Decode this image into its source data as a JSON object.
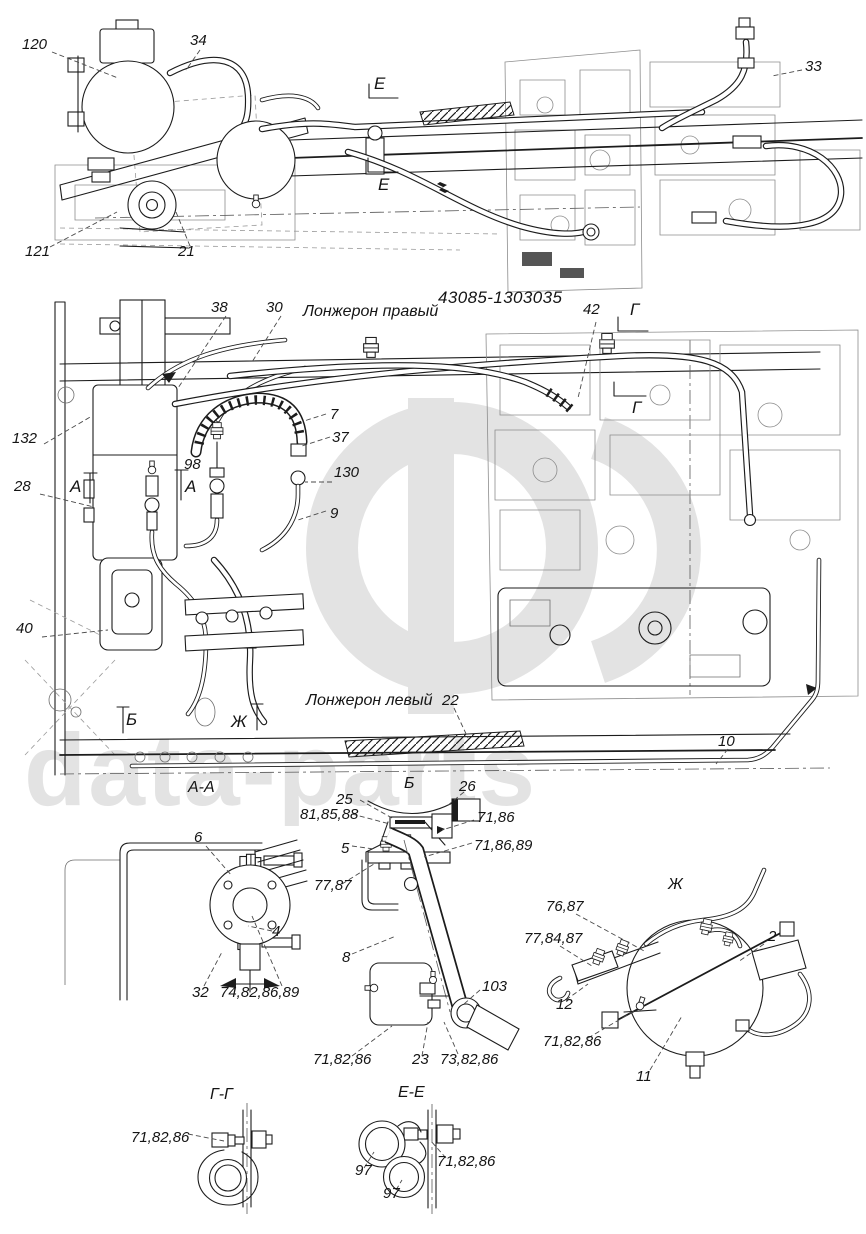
{
  "page": {
    "background": "#ffffff",
    "ink": "#1c1c1c",
    "watermark_color": "#e3e3e3",
    "watermark_text": "data-parts",
    "drawing_number": "43085-1303035"
  },
  "views": {
    "right_longeron_label": "Лонжерон правый",
    "left_longeron_label": "Лонжерон левый",
    "section_titles": [
      "А-А",
      "Б",
      "Ж",
      "Г-Г",
      "Е-Е"
    ],
    "section_markers": [
      "Е",
      "Е",
      "Г",
      "Г",
      "А",
      "А",
      "Б",
      "Ж"
    ]
  },
  "labels": [
    {
      "id": "120",
      "text": "120",
      "x": 22,
      "y": 36,
      "kind": "num"
    },
    {
      "id": "34",
      "text": "34",
      "x": 190,
      "y": 32,
      "kind": "num"
    },
    {
      "id": "33",
      "text": "33",
      "x": 805,
      "y": 58,
      "kind": "num"
    },
    {
      "id": "121",
      "text": "121",
      "x": 25,
      "y": 243,
      "kind": "num"
    },
    {
      "id": "21",
      "text": "21",
      "x": 178,
      "y": 243,
      "kind": "num"
    },
    {
      "id": "marker-e-top",
      "text": "Е",
      "x": 374,
      "y": 74,
      "kind": "marker"
    },
    {
      "id": "marker-e-bottom",
      "text": "Е",
      "x": 378,
      "y": 175,
      "kind": "marker"
    },
    {
      "id": "drawing-number",
      "text": "43085-1303035",
      "x": 438,
      "y": 288,
      "kind": "title-num"
    },
    {
      "id": "right-longeron",
      "text": "Лонжерон правый",
      "x": 303,
      "y": 303,
      "kind": "text"
    },
    {
      "id": "38",
      "text": "38",
      "x": 211,
      "y": 299,
      "kind": "num"
    },
    {
      "id": "30",
      "text": "30",
      "x": 266,
      "y": 299,
      "kind": "num"
    },
    {
      "id": "42",
      "text": "42",
      "x": 583,
      "y": 301,
      "kind": "num"
    },
    {
      "id": "marker-g-top",
      "text": "Г",
      "x": 630,
      "y": 300,
      "kind": "marker"
    },
    {
      "id": "marker-g-bottom",
      "text": "Г",
      "x": 632,
      "y": 398,
      "kind": "marker"
    },
    {
      "id": "132",
      "text": "132",
      "x": 12,
      "y": 430,
      "kind": "num"
    },
    {
      "id": "28",
      "text": "28",
      "x": 14,
      "y": 478,
      "kind": "num"
    },
    {
      "id": "98",
      "text": "98",
      "x": 184,
      "y": 456,
      "kind": "num"
    },
    {
      "id": "marker-a-left",
      "text": "А",
      "x": 70,
      "y": 477,
      "kind": "marker"
    },
    {
      "id": "marker-a-right",
      "text": "А",
      "x": 185,
      "y": 477,
      "kind": "marker"
    },
    {
      "id": "7",
      "text": "7",
      "x": 330,
      "y": 406,
      "kind": "num"
    },
    {
      "id": "37",
      "text": "37",
      "x": 332,
      "y": 429,
      "kind": "num"
    },
    {
      "id": "130",
      "text": "130",
      "x": 334,
      "y": 464,
      "kind": "num"
    },
    {
      "id": "9",
      "text": "9",
      "x": 330,
      "y": 505,
      "kind": "num"
    },
    {
      "id": "40",
      "text": "40",
      "x": 16,
      "y": 620,
      "kind": "num"
    },
    {
      "id": "marker-b",
      "text": "Б",
      "x": 126,
      "y": 710,
      "kind": "marker"
    },
    {
      "id": "marker-zh",
      "text": "Ж",
      "x": 231,
      "y": 712,
      "kind": "marker"
    },
    {
      "id": "left-longeron",
      "text": "Лонжерон левый",
      "x": 306,
      "y": 692,
      "kind": "text"
    },
    {
      "id": "22",
      "text": "22",
      "x": 442,
      "y": 692,
      "kind": "num"
    },
    {
      "id": "10",
      "text": "10",
      "x": 718,
      "y": 733,
      "kind": "num"
    },
    {
      "id": "section-aa",
      "text": "А-А",
      "x": 188,
      "y": 779,
      "kind": "section-title"
    },
    {
      "id": "6",
      "text": "6",
      "x": 194,
      "y": 829,
      "kind": "num"
    },
    {
      "id": "4",
      "text": "4",
      "x": 272,
      "y": 923,
      "kind": "num"
    },
    {
      "id": "32",
      "text": "32",
      "x": 192,
      "y": 984,
      "kind": "num"
    },
    {
      "id": "74-82-86-89",
      "text": "74,82,86,89",
      "x": 220,
      "y": 984,
      "kind": "num"
    },
    {
      "id": "section-b",
      "text": "Б",
      "x": 404,
      "y": 775,
      "kind": "section-title"
    },
    {
      "id": "25",
      "text": "25",
      "x": 336,
      "y": 791,
      "kind": "num"
    },
    {
      "id": "26",
      "text": "26",
      "x": 459,
      "y": 778,
      "kind": "num"
    },
    {
      "id": "81-85-88",
      "text": "81,85,88",
      "x": 300,
      "y": 806,
      "kind": "num"
    },
    {
      "id": "71-86",
      "text": "71,86",
      "x": 477,
      "y": 809,
      "kind": "num"
    },
    {
      "id": "5",
      "text": "5",
      "x": 341,
      "y": 840,
      "kind": "num"
    },
    {
      "id": "71-86-89",
      "text": "71,86,89",
      "x": 474,
      "y": 837,
      "kind": "num"
    },
    {
      "id": "77-87",
      "text": "77,87",
      "x": 314,
      "y": 877,
      "kind": "num"
    },
    {
      "id": "8",
      "text": "8",
      "x": 342,
      "y": 949,
      "kind": "num"
    },
    {
      "id": "103",
      "text": "103",
      "x": 482,
      "y": 978,
      "kind": "num"
    },
    {
      "id": "71-82-86-b",
      "text": "71,82,86",
      "x": 313,
      "y": 1051,
      "kind": "num"
    },
    {
      "id": "23",
      "text": "23",
      "x": 412,
      "y": 1051,
      "kind": "num"
    },
    {
      "id": "73-82-86",
      "text": "73,82,86",
      "x": 440,
      "y": 1051,
      "kind": "num"
    },
    {
      "id": "section-zh",
      "text": "Ж",
      "x": 668,
      "y": 876,
      "kind": "section-title"
    },
    {
      "id": "76-87",
      "text": "76,87",
      "x": 546,
      "y": 898,
      "kind": "num"
    },
    {
      "id": "77-84-87",
      "text": "77,84,87",
      "x": 524,
      "y": 930,
      "kind": "num"
    },
    {
      "id": "2",
      "text": "2",
      "x": 768,
      "y": 928,
      "kind": "num"
    },
    {
      "id": "12",
      "text": "12",
      "x": 556,
      "y": 996,
      "kind": "num"
    },
    {
      "id": "71-82-86-zh",
      "text": "71,82,86",
      "x": 543,
      "y": 1033,
      "kind": "num"
    },
    {
      "id": "11",
      "text": "11",
      "x": 636,
      "y": 1068,
      "kind": "num"
    },
    {
      "id": "section-gg",
      "text": "Г-Г",
      "x": 210,
      "y": 1086,
      "kind": "section-title"
    },
    {
      "id": "71-82-86-gg",
      "text": "71,82,86",
      "x": 131,
      "y": 1129,
      "kind": "num"
    },
    {
      "id": "section-ee",
      "text": "Е-Е",
      "x": 398,
      "y": 1084,
      "kind": "section-title"
    },
    {
      "id": "97-upper",
      "text": "97",
      "x": 355,
      "y": 1162,
      "kind": "num"
    },
    {
      "id": "97-lower",
      "text": "97",
      "x": 383,
      "y": 1185,
      "kind": "num"
    },
    {
      "id": "71-82-86-ee",
      "text": "71,82,86",
      "x": 437,
      "y": 1153,
      "kind": "num"
    }
  ]
}
